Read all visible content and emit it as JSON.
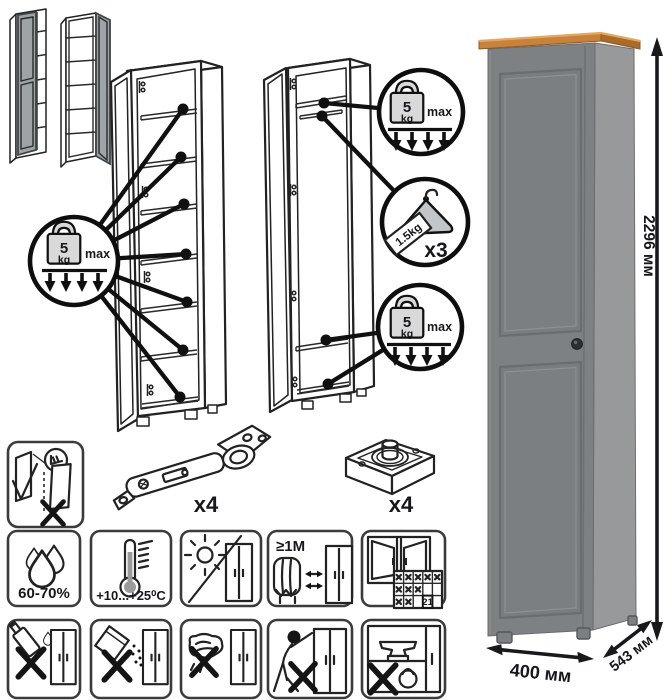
{
  "diagrams": {
    "shelf_load_circle": {
      "value": "5",
      "unit": "kg",
      "qualifier": "max"
    },
    "top_shelf_load_circle": {
      "value": "5",
      "unit": "kg",
      "qualifier": "max"
    },
    "bottom_load_circle": {
      "value": "5",
      "unit": "kg",
      "qualifier": "max"
    },
    "hanger_circle": {
      "tag_weight": "1.5kg",
      "count": "x3"
    }
  },
  "product": {
    "height_label": "2296 мм",
    "width_label": "400 мм",
    "depth_label": "543 мм",
    "colors": {
      "front": "#7e8183",
      "side": "#97999b",
      "top_wood": "#c8823c",
      "top_wood_side": "#aa6a2a",
      "knob": "#2e3133"
    }
  },
  "hardware": {
    "hinge_qty": "x4",
    "leg_qty": "x4"
  },
  "care": {
    "humidity": "60-70%",
    "temperature": "+10...+25⁰C",
    "min_heat_distance": "≥1М",
    "calendar_day": "21"
  }
}
